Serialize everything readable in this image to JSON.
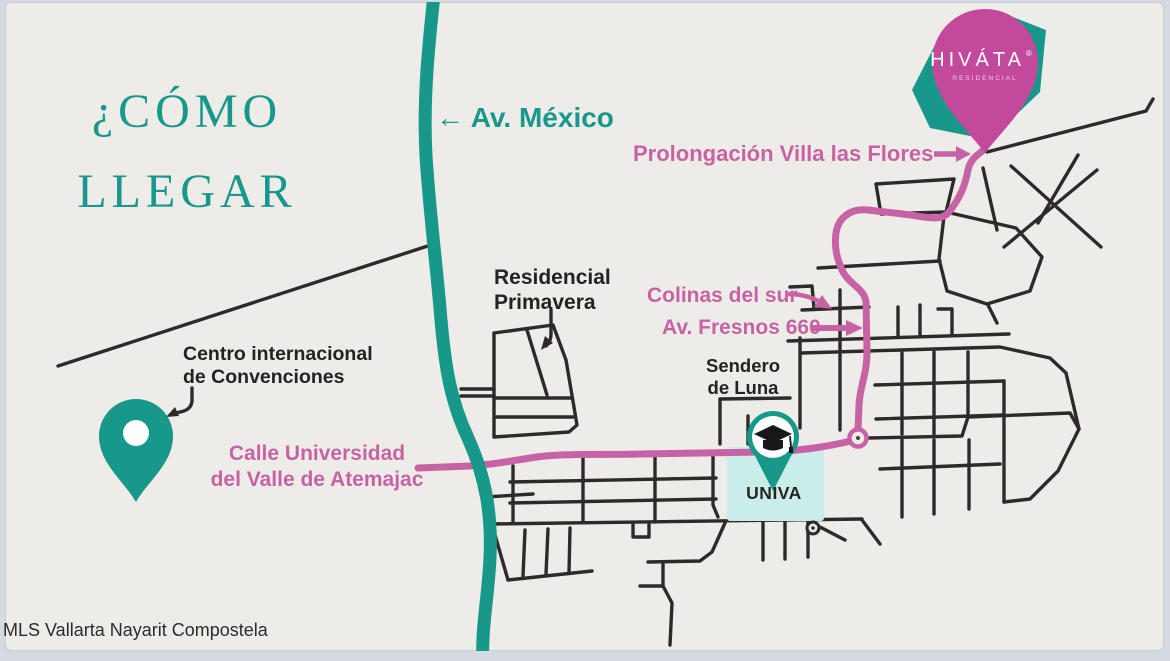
{
  "colors": {
    "teal": "#17988b",
    "pink": "#c763a5",
    "pink_deep": "#c2499b",
    "light_teal": "#c9eeea",
    "street": "#2e2a2b",
    "slide_bg": "#edece9",
    "page_bg": "#d5d9e2",
    "text_dark": "#262223",
    "watermark_color": "#2b2b2b",
    "white": "#ffffff"
  },
  "title": {
    "line1": "¿CÓMO",
    "line2": "LLEGAR"
  },
  "labels": {
    "av_mexico": "← Av. México",
    "prolongacion_villa_las_flores": "Prolongación Villa las Flores",
    "residencial_primavera": {
      "line1": "Residencial",
      "line2": "Primavera"
    },
    "colinas_del_sur": "Colinas del sur",
    "av_fresnos": "Av. Fresnos 660",
    "centro_convenciones": {
      "line1": "Centro internacional",
      "line2": "de Convenciones"
    },
    "calle_universidad": {
      "line1": "Calle Universidad",
      "line2": "del Valle de Atemajac"
    },
    "sendero_de_luna": {
      "line1": "Sendero",
      "line2": "de Luna"
    },
    "univa": "UNIVA"
  },
  "hivata_pin": {
    "brand": "HIVÁTA",
    "registered": "®",
    "subtitle": "RESIDENCIAL"
  },
  "watermark": "MLS Vallarta Nayarit Compostela",
  "icons": {
    "hivata_pin": "map-pin",
    "centro_pin": "map-pin",
    "univa_pin": "graduation-cap-pin",
    "route_arrows": "arrow-right",
    "av_mexico_arrow": "arrow-left"
  }
}
